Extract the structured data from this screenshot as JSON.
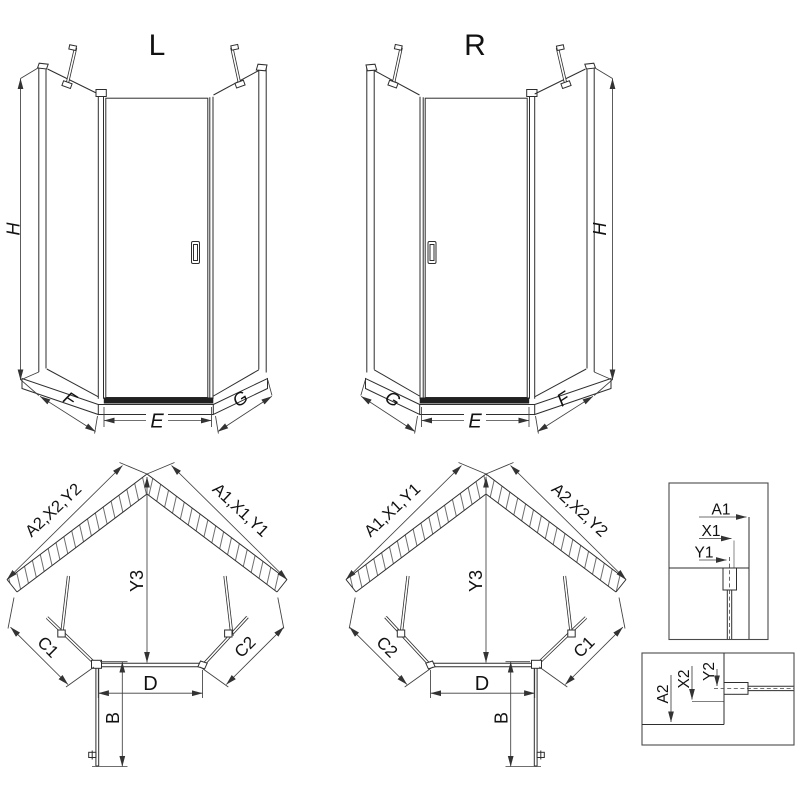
{
  "elevation_left": {
    "title": "L",
    "height_label": "H",
    "left_dim_label": "F",
    "door_dim_label": "E",
    "right_dim_label": "G"
  },
  "elevation_right": {
    "title": "R",
    "height_label": "H",
    "left_dim_label": "G",
    "door_dim_label": "E",
    "right_dim_label": "F"
  },
  "plan_left": {
    "left_wall_label": "A2,X2,Y2",
    "right_wall_label": "A1,X1,Y1",
    "depth_label": "Y3",
    "left_panel_label": "C1",
    "right_panel_label": "C2",
    "door_width_label": "D",
    "door_swing_label": "B"
  },
  "plan_right": {
    "left_wall_label": "A1,X1,Y1",
    "right_wall_label": "A2,X2,Y2",
    "depth_label": "Y3",
    "left_panel_label": "C2",
    "right_panel_label": "C1",
    "door_width_label": "D",
    "door_swing_label": "B"
  },
  "detail_horizontal": {
    "a_label": "A1",
    "x_label": "X1",
    "y_label": "Y1"
  },
  "detail_vertical": {
    "a_label": "A2",
    "x_label": "X2",
    "y_label": "Y2"
  },
  "colors": {
    "line": "#2e2e2e",
    "dimension": "#3f3f3f",
    "text": "#111111",
    "threshold": "#212121",
    "background": "#ffffff"
  }
}
